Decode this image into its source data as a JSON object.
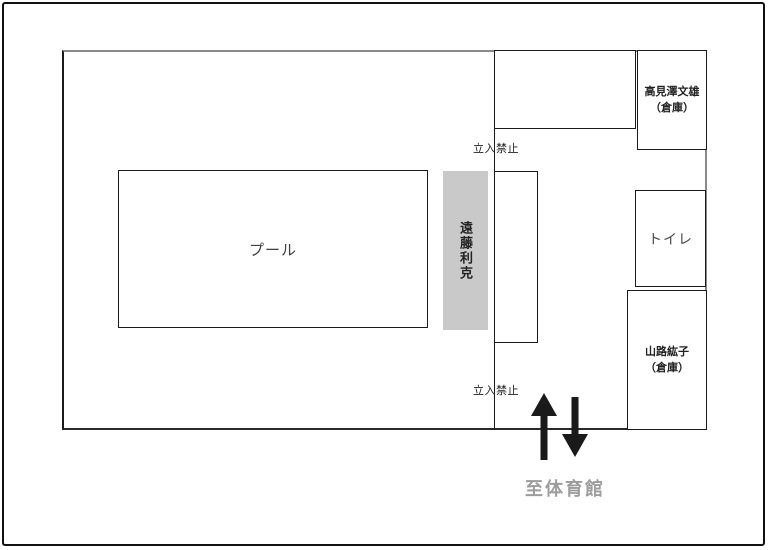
{
  "map": {
    "pool": {
      "label": "プール"
    },
    "installation": {
      "label": "遠藤利克",
      "fill_color": "#c9c9c9"
    },
    "no_entry_top": {
      "label": "立入禁止"
    },
    "no_entry_bottom": {
      "label": "立入禁止"
    },
    "storage_takamizawa": {
      "line1": "高見澤文雄",
      "line2": "（倉庫）"
    },
    "toilet": {
      "label": "トイレ"
    },
    "storage_yamaji": {
      "line1": "山路紘子",
      "line2": "（倉庫）"
    },
    "to_gymnasium": {
      "label": "至体育館",
      "color": "#9c9c9c"
    },
    "arrows": {
      "up": "up-arrow",
      "down": "down-arrow",
      "color": "#1a1a1a"
    },
    "walls": {
      "dark": "#1a1a1a",
      "gray": "#8a8a8a"
    }
  }
}
